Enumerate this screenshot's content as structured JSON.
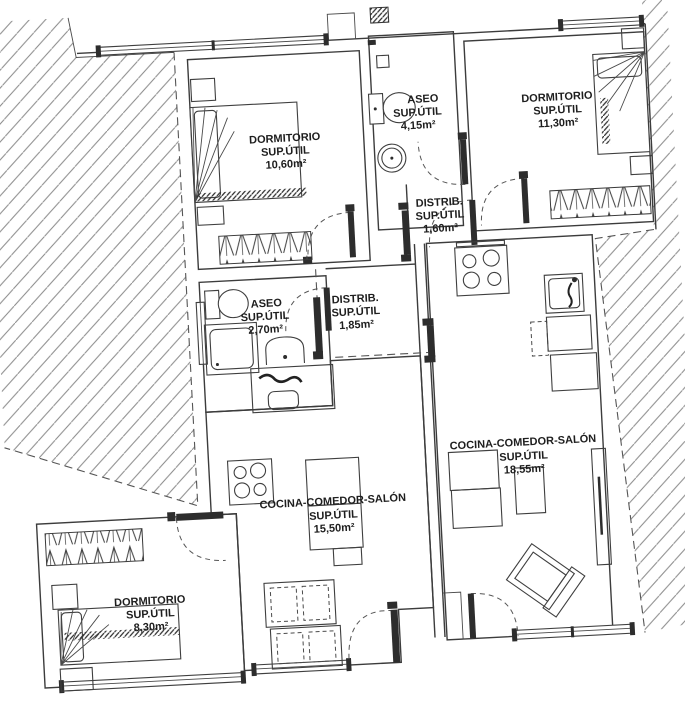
{
  "plan": {
    "colors": {
      "background": "#ffffff",
      "line": "#3c3c3c",
      "hatch": "#8a8a8a",
      "door_leaf": "#2d2d2d",
      "text": "#1e1e1e"
    },
    "rooms": [
      {
        "name": "DORMITORIO",
        "sup": "SUP.ÚTIL",
        "area": "10,60m²"
      },
      {
        "name": "ASEO",
        "sup": "SUP.ÚTIL",
        "area": "4,15m²"
      },
      {
        "name": "DORMITORIO",
        "sup": "SUP.ÚTIL",
        "area": "11,30m²"
      },
      {
        "name": "DISTRIB.",
        "sup": "SUP.ÚTIL",
        "area": "1,60m²"
      },
      {
        "name": "ASEO",
        "sup": "SUP.ÚTIL",
        "area": "2,70m²"
      },
      {
        "name": "DISTRIB.",
        "sup": "SUP.ÚTIL",
        "area": "1,85m²"
      },
      {
        "name": "COCINA-COMEDOR-SALÓN",
        "sup": "SUP.ÚTIL",
        "area": "18,55m²"
      },
      {
        "name": "COCINA-COMEDOR-SALÓN",
        "sup": "SUP.ÚTIL",
        "area": "15,50m²"
      },
      {
        "name": "DORMITORIO",
        "sup": "SUP.ÚTIL",
        "area": "8,30m²"
      }
    ]
  }
}
